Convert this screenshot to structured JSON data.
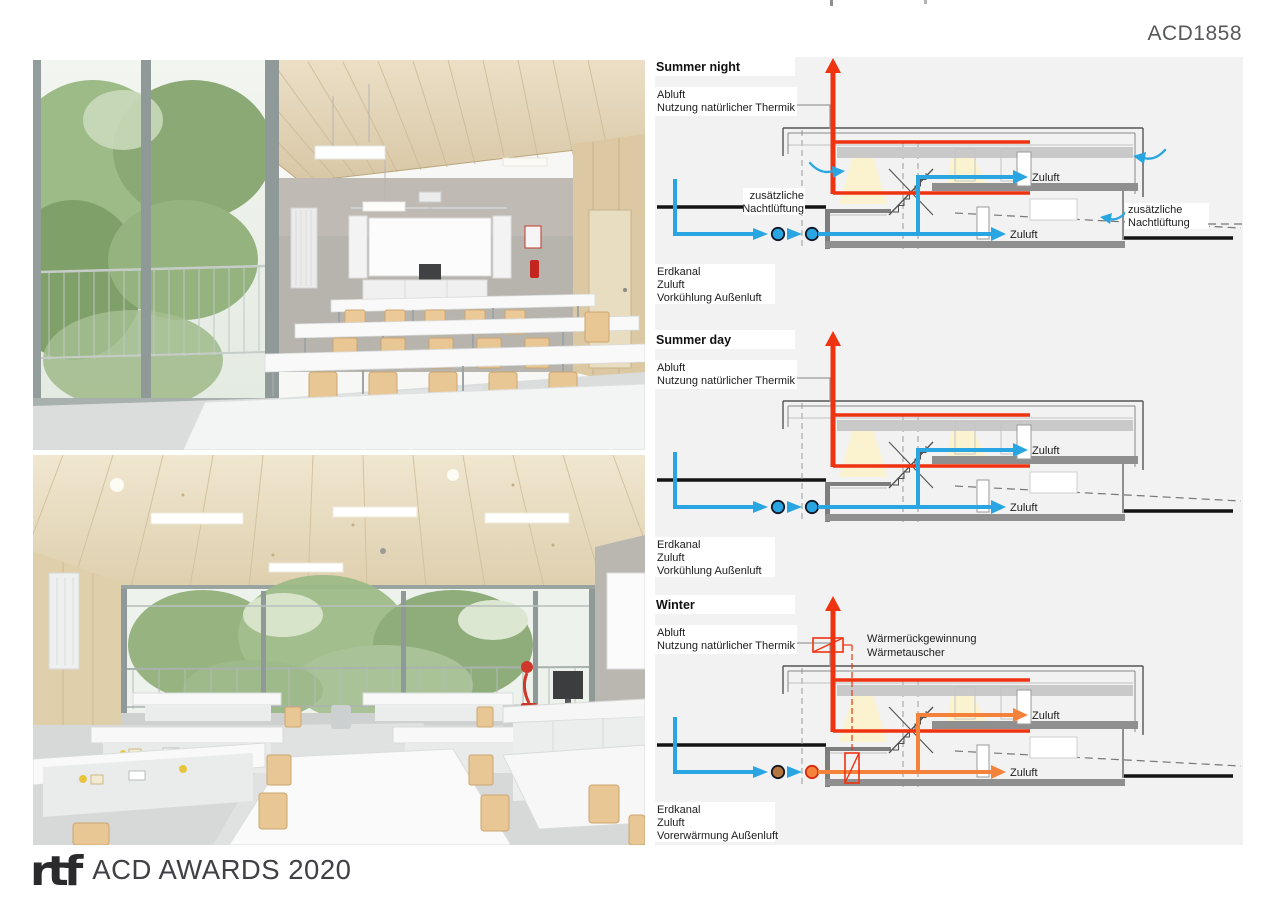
{
  "header": {
    "project_code": "ACD1858"
  },
  "footer": {
    "logo_text": "rtf",
    "award_text": "ACD AWARDS 2020"
  },
  "colors": {
    "supply_air_blue": "#29a6e2",
    "exhaust_air_red": "#ee3311",
    "preheated_air_orange": "#f5823b",
    "panel_background": "#f2f2f2",
    "ground_line": "#141414",
    "slab_gray": "#8f8f8f",
    "band_gray": "#c9c9c9",
    "label_background": "#ffffff",
    "leader_gray": "#9a9a9a",
    "light_cone_yellow": "#fdf3c6",
    "header_text": "#57585a",
    "footer_text": "#414044"
  },
  "diagrams": [
    {
      "id": "summer-night",
      "title": "Summer night",
      "exhaust_label_lines": [
        "Abluft",
        "Nutzung natürlicher Thermik"
      ],
      "supply_upper_label": "Zuluft",
      "supply_lower_label": "Zuluft",
      "night_vent_left_lines": [
        "zusätzliche",
        "Nachtlüftung"
      ],
      "night_vent_right_lines": [
        "zusätzliche",
        "Nachtlüftung"
      ],
      "bottom_label_lines": [
        "Erdkanal",
        "Zuluft",
        "Vorkühlung Außenluft"
      ],
      "features": {
        "night_vent": true,
        "heat_exchanger": false,
        "supply_mode": "blue"
      }
    },
    {
      "id": "summer-day",
      "title": "Summer day",
      "exhaust_label_lines": [
        "Abluft",
        "Nutzung natürlicher Thermik"
      ],
      "supply_upper_label": "Zuluft",
      "supply_lower_label": "Zuluft",
      "bottom_label_lines": [
        "Erdkanal",
        "Zuluft",
        "Vorkühlung Außenluft"
      ],
      "features": {
        "night_vent": false,
        "heat_exchanger": false,
        "supply_mode": "blue"
      }
    },
    {
      "id": "winter",
      "title": "Winter",
      "exhaust_label_lines": [
        "Abluft",
        "Nutzung natürlicher Thermik"
      ],
      "heat_recovery_label_lines": [
        "Wärmerückgewinnung",
        "Wärmetauscher"
      ],
      "supply_upper_label": "Zuluft",
      "supply_lower_label": "Zuluft",
      "bottom_label_lines": [
        "Erdkanal",
        "Zuluft",
        "Vorerwärmung Außenluft"
      ],
      "features": {
        "night_vent": false,
        "heat_exchanger": true,
        "supply_mode": "preheated"
      }
    }
  ]
}
